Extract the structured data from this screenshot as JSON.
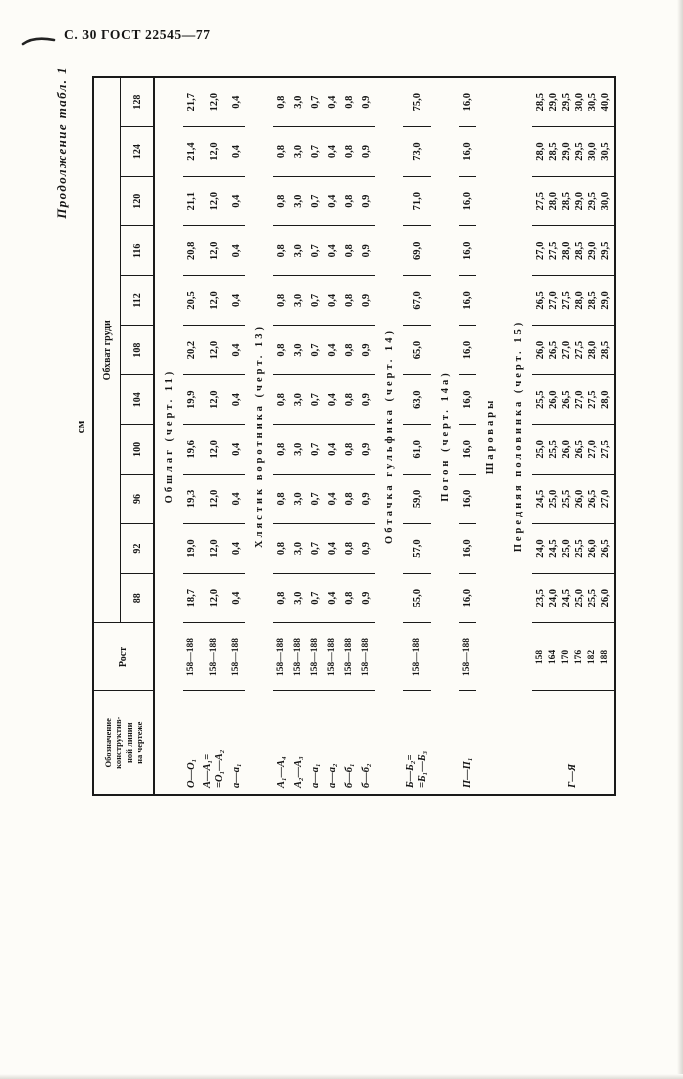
{
  "page_header": {
    "title": "С. 30 ГОСТ 22545—77"
  },
  "table": {
    "continuation": "Продолжение табл. 1",
    "units": "см",
    "header": {
      "designation_lines": [
        "Обозначение",
        "конструктив-",
        "ной линии",
        "на чертеже"
      ],
      "rost": "Рост",
      "chest_span": "Обхват груди",
      "sizes": [
        "88",
        "92",
        "96",
        "100",
        "104",
        "108",
        "112",
        "116",
        "120",
        "124",
        "128"
      ]
    },
    "sections": [
      {
        "title": "Обшлаг (черт. 11)",
        "rows": [
          {
            "designation": [
              "О—О₁"
            ],
            "rost": [
              "158—188"
            ],
            "values": [
              "18,7",
              "19,0",
              "19,3",
              "19,6",
              "19,9",
              "20,2",
              "20,5",
              "20,8",
              "21,1",
              "21,4",
              "21,7"
            ]
          },
          {
            "designation": [
              "А—А₁=",
              "=О₁—А₂"
            ],
            "rost": [
              "158—188"
            ],
            "values": [
              "12,0",
              "12,0",
              "12,0",
              "12,0",
              "12,0",
              "12,0",
              "12,0",
              "12,0",
              "12,0",
              "12,0",
              "12,0"
            ]
          },
          {
            "designation": [
              "а—а₁"
            ],
            "rost": [
              "158—188"
            ],
            "values": [
              "0,4",
              "0,4",
              "0,4",
              "0,4",
              "0,4",
              "0,4",
              "0,4",
              "0,4",
              "0,4",
              "0,4",
              "0,4"
            ]
          }
        ]
      },
      {
        "title": "Хлястик воротника (черт. 13)",
        "rows": [
          {
            "designation": [
              "А₁—А₄"
            ],
            "rost": [
              "158—188"
            ],
            "values": [
              "0,8",
              "0,8",
              "0,8",
              "0,8",
              "0,8",
              "0,8",
              "0,8",
              "0,8",
              "0,8",
              "0,8",
              "0,8"
            ]
          },
          {
            "designation": [
              "А₂—А₃"
            ],
            "rost": [
              "158—188"
            ],
            "values": [
              "3,0",
              "3,0",
              "3,0",
              "3,0",
              "3,0",
              "3,0",
              "3,0",
              "3,0",
              "3,0",
              "3,0",
              "3,0"
            ]
          },
          {
            "designation": [
              "а—а₁"
            ],
            "rost": [
              "158—188"
            ],
            "values": [
              "0,7",
              "0,7",
              "0,7",
              "0,7",
              "0,7",
              "0,7",
              "0,7",
              "0,7",
              "0,7",
              "0,7",
              "0,7"
            ]
          },
          {
            "designation": [
              "а—а₂"
            ],
            "rost": [
              "158—188"
            ],
            "values": [
              "0,4",
              "0,4",
              "0,4",
              "0,4",
              "0,4",
              "0,4",
              "0,4",
              "0,4",
              "0,4",
              "0,4",
              "0,4"
            ]
          },
          {
            "designation": [
              "б—б₁"
            ],
            "rost": [
              "158—188"
            ],
            "values": [
              "0,8",
              "0,8",
              "0,8",
              "0,8",
              "0,8",
              "0,8",
              "0,8",
              "0,8",
              "0,8",
              "0,8",
              "0,8"
            ]
          },
          {
            "designation": [
              "б—б₂"
            ],
            "rost": [
              "158—188"
            ],
            "values": [
              "0,9",
              "0,9",
              "0,9",
              "0,9",
              "0,9",
              "0,9",
              "0,9",
              "0,9",
              "0,9",
              "0,9",
              "0,9"
            ]
          }
        ]
      },
      {
        "title": "Обтачка гульфика (черт. 14)",
        "rows": [
          {
            "designation": [
              "Б—Б₂=",
              "=Б₁—Б₃"
            ],
            "rost": [
              "158—188"
            ],
            "values": [
              "55,0",
              "57,0",
              "59,0",
              "61,0",
              "63,0",
              "65,0",
              "67,0",
              "69,0",
              "71,0",
              "73,0",
              "75,0"
            ]
          }
        ]
      },
      {
        "title": "Погон (черт. 14а)",
        "rows": [
          {
            "designation": [
              "П—П₁"
            ],
            "rost": [
              "158—188"
            ],
            "values": [
              "16,0",
              "16,0",
              "16,0",
              "16,0",
              "16,0",
              "16,0",
              "16,0",
              "16,0",
              "16,0",
              "16,0",
              "16,0"
            ]
          }
        ]
      },
      {
        "title": "Шаровары",
        "rows": []
      },
      {
        "title": "Передняя половинка (черт. 15)",
        "rows": [
          {
            "designation": [
              "Г—Я"
            ],
            "rost_rows": [
              {
                "rost": "158",
                "values": [
                  "23,5",
                  "24,0",
                  "24,5",
                  "25,0",
                  "25,5",
                  "26,0",
                  "26,5",
                  "27,0",
                  "27,5",
                  "28,0",
                  "28,5"
                ]
              },
              {
                "rost": "164",
                "values": [
                  "24,0",
                  "24,5",
                  "25,0",
                  "25,5",
                  "26,0",
                  "26,5",
                  "27,0",
                  "27,5",
                  "28,0",
                  "28,5",
                  "29,0"
                ]
              },
              {
                "rost": "170",
                "values": [
                  "24,5",
                  "25,0",
                  "25,5",
                  "26,0",
                  "26,5",
                  "27,0",
                  "27,5",
                  "28,0",
                  "28,5",
                  "29,0",
                  "29,5"
                ]
              },
              {
                "rost": "176",
                "values": [
                  "25,0",
                  "25,5",
                  "26,0",
                  "26,5",
                  "27,0",
                  "27,5",
                  "28,0",
                  "28,5",
                  "29,0",
                  "29,5",
                  "30,0"
                ]
              },
              {
                "rost": "182",
                "values": [
                  "25,5",
                  "26,0",
                  "26,5",
                  "27,0",
                  "27,5",
                  "28,0",
                  "28,5",
                  "29,0",
                  "29,5",
                  "30,0",
                  "30,5"
                ]
              },
              {
                "rost": "188",
                "values": [
                  "26,0",
                  "26,5",
                  "27,0",
                  "27,5",
                  "28,0",
                  "28,5",
                  "29,0",
                  "29,5",
                  "30,0",
                  "30,5",
                  "40,0"
                ]
              }
            ]
          }
        ]
      }
    ]
  }
}
